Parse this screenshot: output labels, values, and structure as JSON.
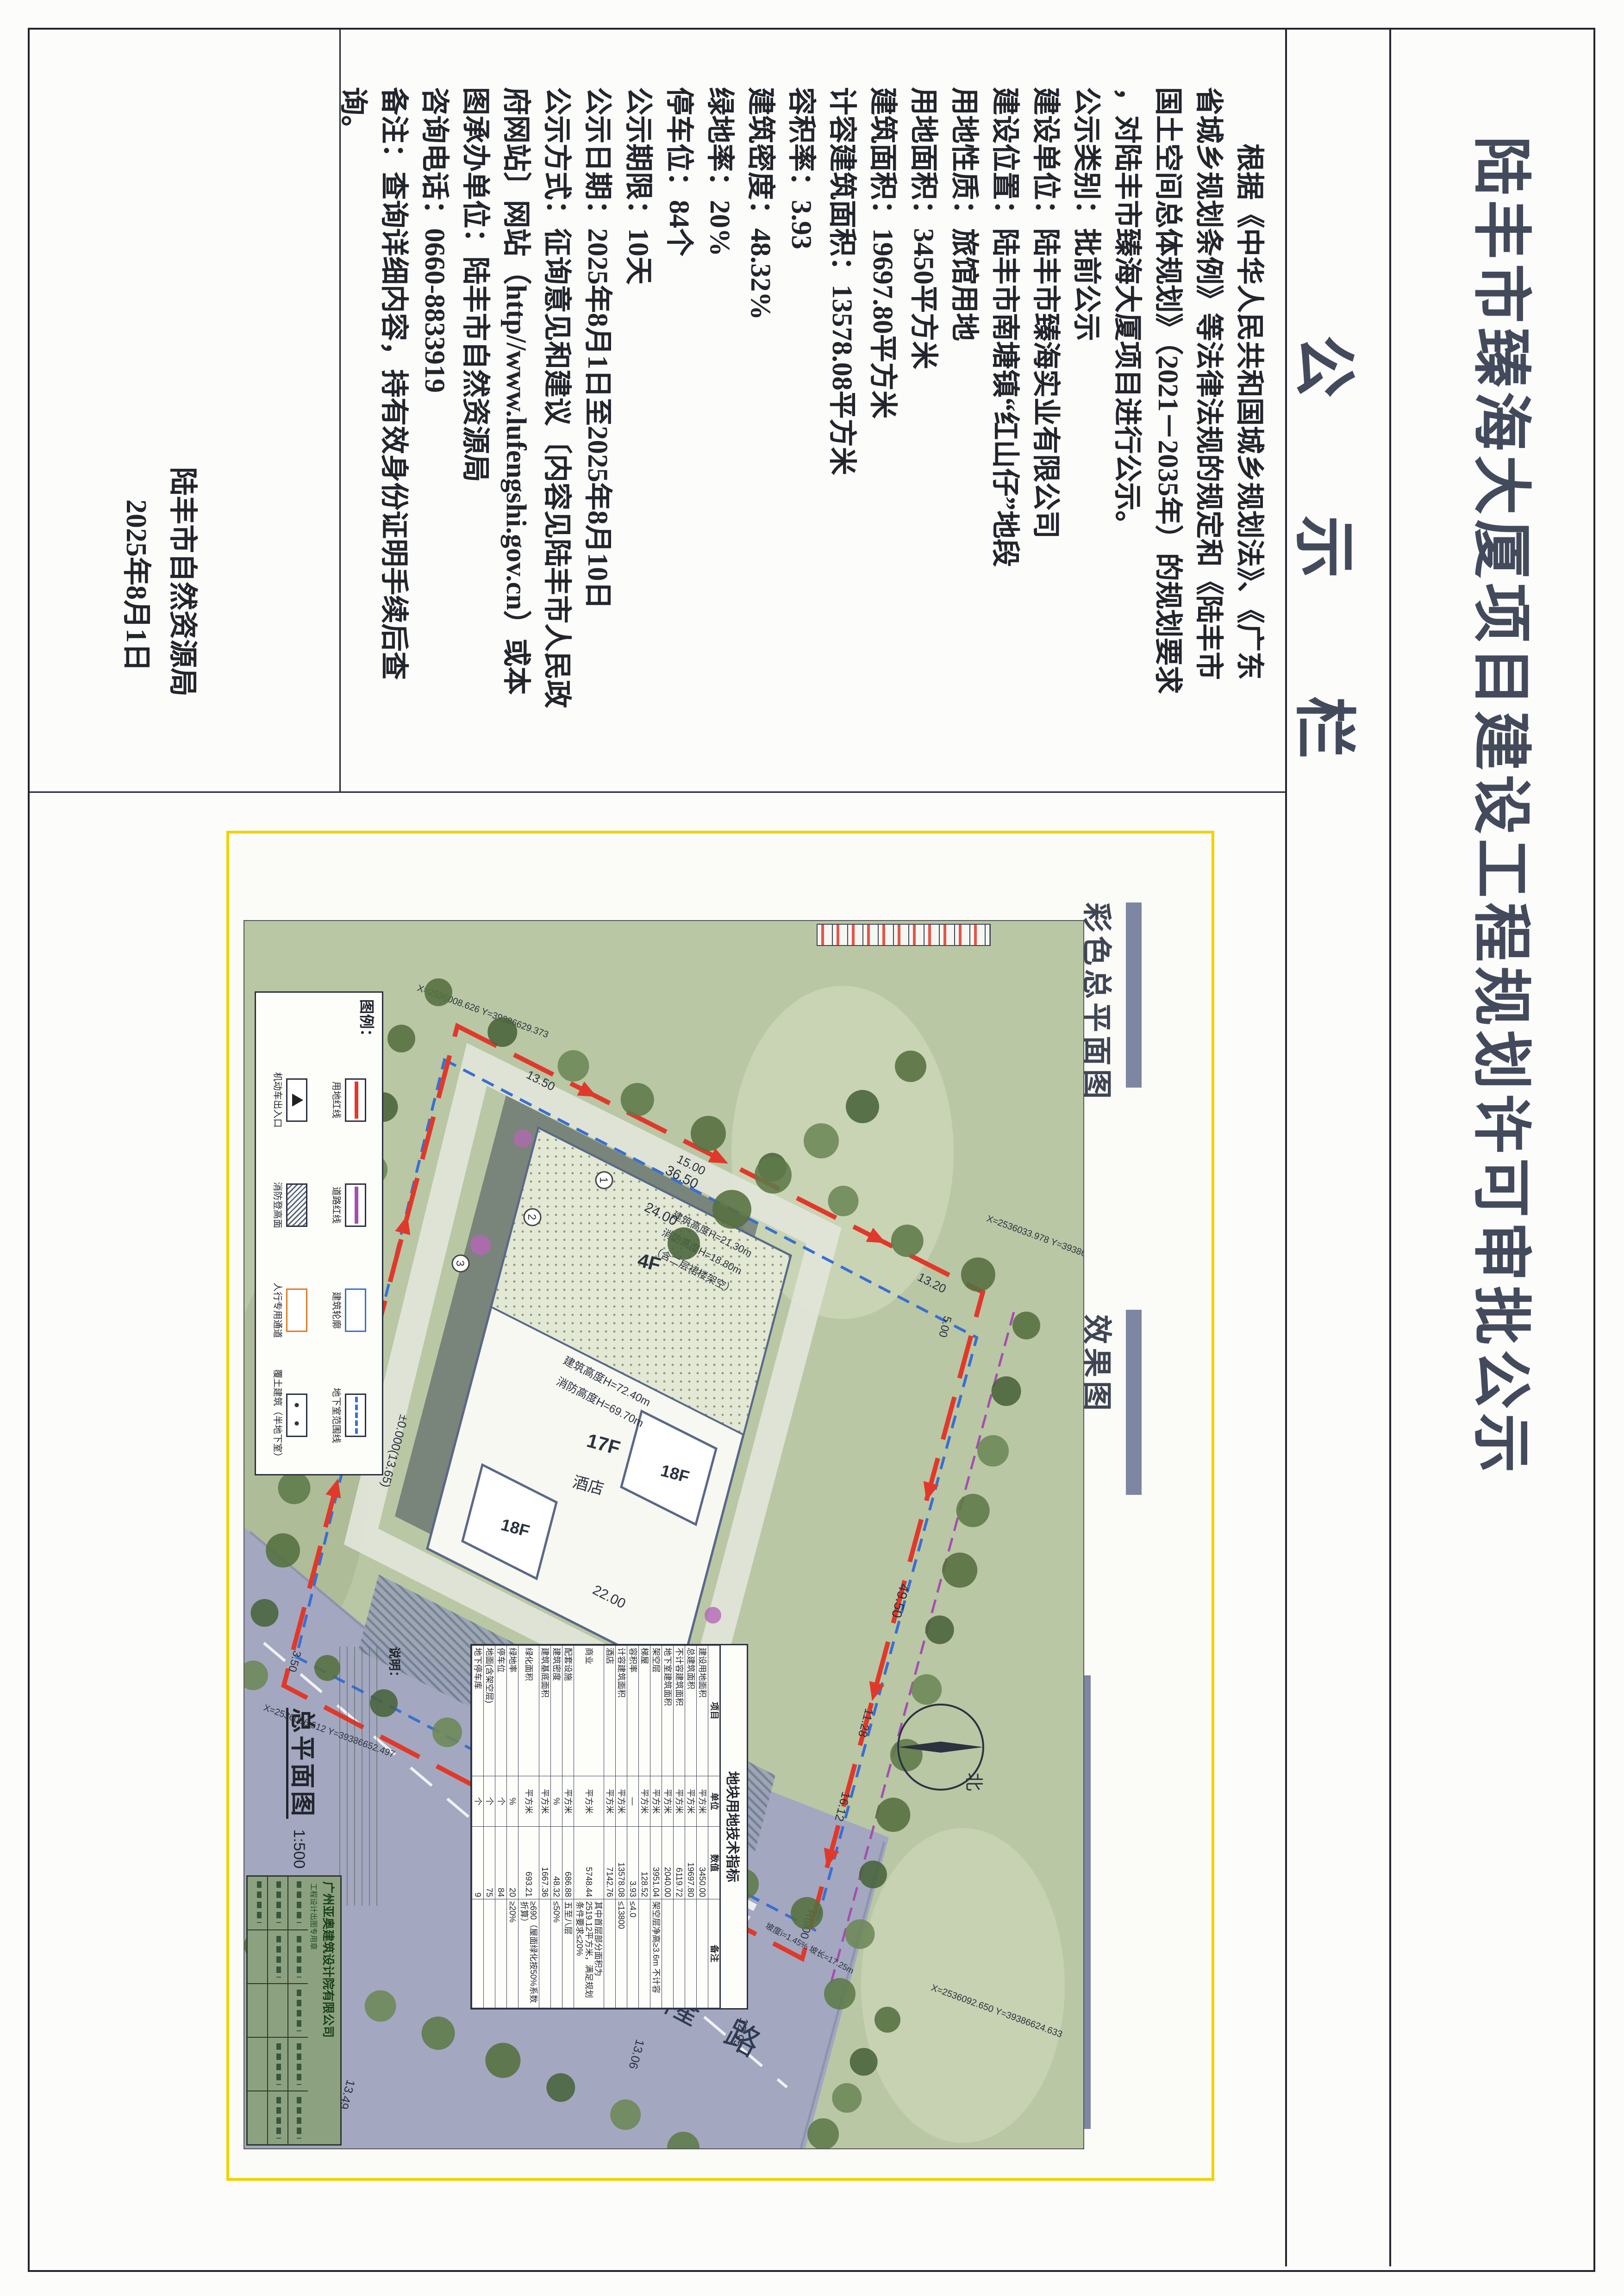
{
  "document": {
    "title": "陆丰市臻海大厦项目建设工程规划许可审批公示",
    "board_label": "公示栏",
    "notice_lines": [
      "　　根据《中华人民共和国城乡规划法》、《广东",
      "省城乡规划条例》等法律法规的规定和《陆丰市",
      "国土空间总体规划》（2021－2035年）的规划要求",
      "，对陆丰市臻海大厦项目进行公示。",
      "公示类别：批前公示",
      "建设单位：陆丰市臻海实业有限公司",
      "建设位置：陆丰市南塘镇“红山仔”地段",
      "用地性质：旅馆用地",
      "用地面积：3450平方米",
      "建筑面积：19697.80平方米",
      "计容建筑面积：13578.08平方米",
      "容积率：3.93",
      "建筑密度：48.32%",
      "绿地率：20%",
      "停车位：84个",
      "公示期限：10天",
      "公示日期：2025年8月1日至2025年8月10日",
      "公示方式：征询意见和建议〔内容见陆丰市人民政",
      "府网站〕网站（http//www.lufengshi.gov.cn）或本",
      "图承办单位：陆丰市自然资源局",
      "咨询电话：0660-8833919",
      "备注：查询详细内容，持有效身份证明手续后查",
      "询。"
    ],
    "signature": {
      "org": "陆丰市自然资源局",
      "date": "2025年8月1日"
    }
  },
  "attachment": {
    "panel_labels": {
      "site_plan": "彩色总平面图",
      "rendering": "效果图"
    },
    "plan": {
      "scale_name": "总平面图",
      "scale_ratio": "1:500",
      "north_label": "北",
      "road_name": "车隆路",
      "legend_title": "图例：",
      "legend_items": [
        {
          "label": "用地红线"
        },
        {
          "label": "道路红线"
        },
        {
          "label": "建筑轮廓"
        },
        {
          "label": "地下室范围线"
        },
        {
          "label": "机动车出入口"
        },
        {
          "label": "消防登高面"
        },
        {
          "label": "人行专用通道"
        },
        {
          "label": "覆土建筑（半地下室）"
        }
      ],
      "coordinates": [
        "X=2536008.626 Y=39386629.373",
        "X=2536033.978 Y=39386596.858",
        "X=2536092.650 Y=39386624.633",
        "X=2536056.512 Y=39386652.497"
      ],
      "dims": [
        "36.50",
        "24.00",
        "22.00",
        "±0.000(13.65)",
        "49.50",
        "11.28",
        "16.12",
        "28.74",
        "13.20",
        "5.00",
        "15.00",
        "13.50",
        "12.95",
        "13.06",
        "18.00",
        "13.49",
        "R6.00",
        "3.50"
      ],
      "building_labels": {
        "f4": "4F",
        "f17": "17F",
        "f18a": "18F",
        "f18b": "18F",
        "hotel": "酒店"
      },
      "height_notes": {
        "tower": "建筑高度H=72.40m",
        "tower2": "消防高度H=69.70m",
        "podium": "建筑高度H=21.30m",
        "podium2": "消防高度H=18.80m",
        "podium3": "（含二层裙楼架空）"
      },
      "slope_note": "坡度i=1.45% 坡长=17.25m",
      "line_labels": {
        "site": "用地红线",
        "road": "道路红线"
      },
      "notes_title": "说明：",
      "indicator_table": {
        "title": "地块用地技术指标",
        "headers": [
          "项目",
          "单位",
          "数值",
          "备注"
        ],
        "rows": [
          [
            "建设用地面积",
            "平方米",
            "3450.00",
            ""
          ],
          [
            "总建筑面积",
            "平方米",
            "19697.80",
            ""
          ],
          [
            "不计容建筑面积",
            "平方米",
            "6119.72",
            ""
          ],
          [
            "地下室建筑面积",
            "平方米",
            "2040.00",
            ""
          ],
          [
            "架空层",
            "平方米",
            "3951.04",
            "架空层净高≥3.6m 不计容"
          ],
          [
            "梯屋",
            "平方米",
            "128.52",
            ""
          ],
          [
            "容积率",
            "—",
            "3.93",
            "≤4.0"
          ],
          [
            "计容建筑面积",
            "平方米",
            "13578.08",
            "≤13800"
          ],
          [
            "酒店",
            "平方米",
            "7142.76",
            ""
          ],
          [
            "商业",
            "平方米",
            "5748.44",
            "其中首层部分面积为2519.12平方米，满足规划条件要求≤20%"
          ],
          [
            "配套设施",
            "平方米",
            "686.88",
            "五至八层"
          ],
          [
            "建筑密度",
            "%",
            "48.32",
            "≤50%"
          ],
          [
            "建筑基底面积",
            "平方米",
            "1667.36",
            ""
          ],
          [
            "绿化面积",
            "平方米",
            "693.21",
            "≥690（屋面绿化按50%系数折算）"
          ],
          [
            "绿地率",
            "%",
            "20",
            "≥20%"
          ],
          [
            "停车位",
            "个",
            "84",
            ""
          ],
          [
            "地面(含架空层)",
            "个",
            "75",
            ""
          ],
          [
            "地下停车库",
            "个",
            "9",
            ""
          ]
        ]
      },
      "title_block": {
        "company": "广州亚奥建筑设计院有限公司",
        "stamp": "工程设计出图专用章"
      }
    }
  }
}
